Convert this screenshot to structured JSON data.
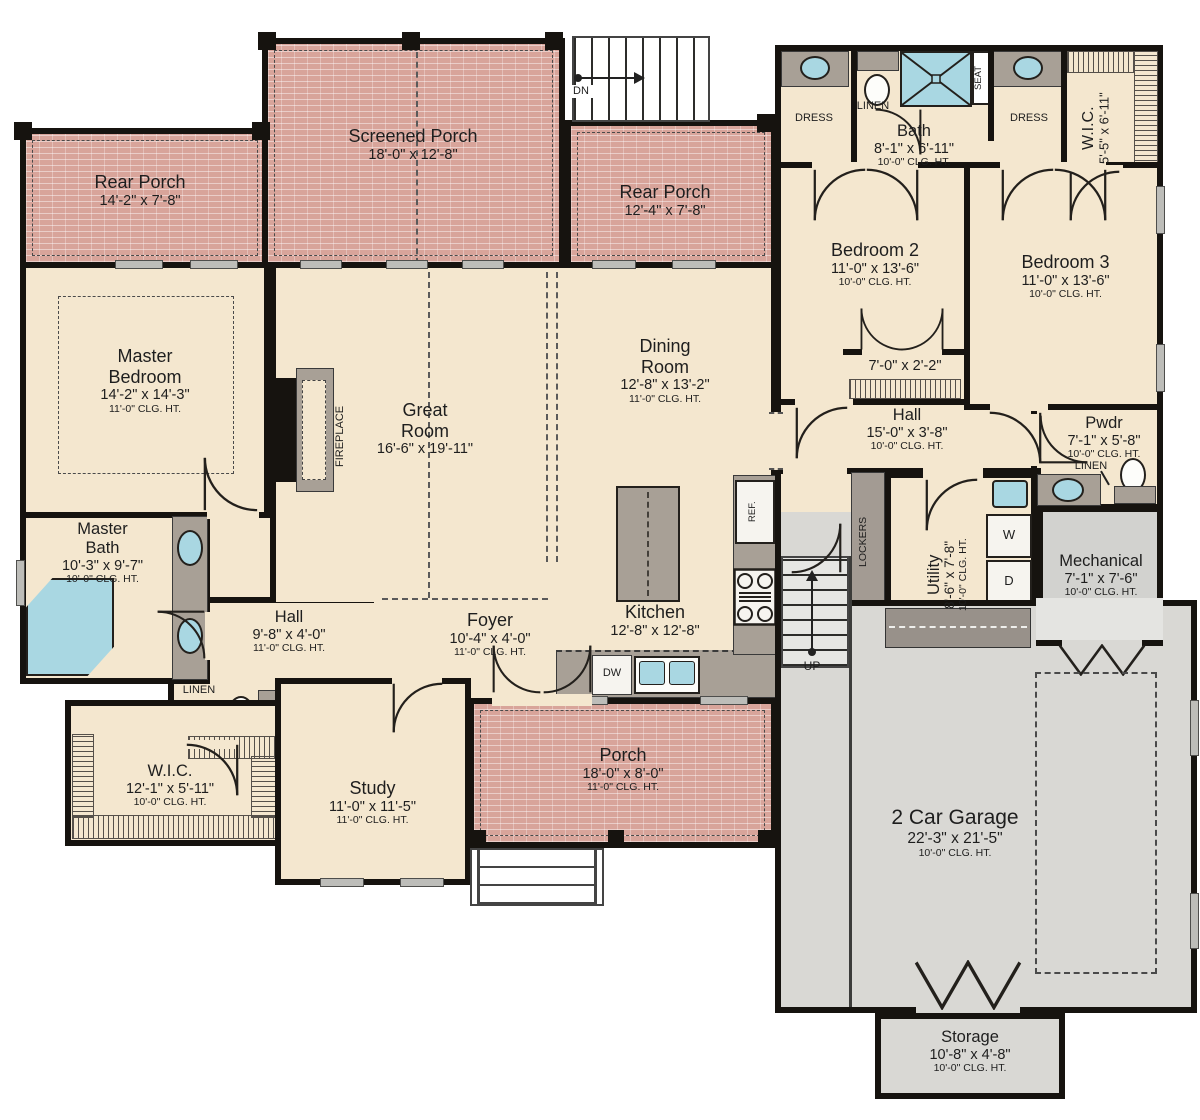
{
  "rooms": {
    "rear_porch_left": {
      "name": "Rear Porch",
      "dims": "14'-2\" x 7'-8\""
    },
    "screened_porch": {
      "name": "Screened Porch",
      "dims": "18'-0\" x 12'-8\""
    },
    "rear_porch_right": {
      "name": "Rear Porch",
      "dims": "12'-4\" x 7'-8\""
    },
    "bath": {
      "name": "Bath",
      "dims": "8'-1\" x 6'-11\"",
      "clg": "10'-0\" CLG. HT."
    },
    "wic_upper": {
      "name": "W.I.C.",
      "dims": "5'-5\" x 6'-11\""
    },
    "bedroom2": {
      "name": "Bedroom 2",
      "dims": "11'-0\" x 13'-6\"",
      "clg": "10'-0\" CLG. HT."
    },
    "bedroom3": {
      "name": "Bedroom 3",
      "dims": "11'-0\" x 13'-6\"",
      "clg": "10'-0\" CLG. HT."
    },
    "closet_between": {
      "dims": "7'-0\" x 2'-2\""
    },
    "hall_bedrooms": {
      "name": "Hall",
      "dims": "15'-0\" x 3'-8\"",
      "clg": "10'-0\" CLG. HT."
    },
    "pwdr": {
      "name": "Pwdr",
      "dims": "7'-1\" x 5'-8\"",
      "clg": "10'-0\" CLG. HT."
    },
    "utility": {
      "name": "Utility",
      "dims": "8'-6\" x 7'-8\"",
      "clg": "10'-0\" CLG. HT."
    },
    "mechanical": {
      "name": "Mechanical",
      "dims": "7'-1\" x 7'-6\"",
      "clg": "10'-0\" CLG. HT."
    },
    "master_bedroom": {
      "name": "Master Bedroom",
      "dims": "14'-2\" x 14'-3\"",
      "clg": "11'-0\" CLG. HT."
    },
    "great_room": {
      "name": "Great Room",
      "dims": "16'-6\" x 19'-11\""
    },
    "dining_room": {
      "name": "Dining Room",
      "dims": "12'-8\" x 13'-2\"",
      "clg": "11'-0\" CLG. HT."
    },
    "kitchen": {
      "name": "Kitchen",
      "dims": "12'-8\" x 12'-8\""
    },
    "master_bath": {
      "name": "Master Bath",
      "dims": "10'-3\" x 9'-7\"",
      "clg": "10'-0\" CLG. HT."
    },
    "hall_master": {
      "name": "Hall",
      "dims": "9'-8\" x 4'-0\"",
      "clg": "11'-0\" CLG. HT."
    },
    "foyer": {
      "name": "Foyer",
      "dims": "10'-4\" x 4'-0\"",
      "clg": "11'-0\" CLG. HT."
    },
    "wic_master": {
      "name": "W.I.C.",
      "dims": "12'-1\" x 5'-11\"",
      "clg": "10'-0\" CLG. HT."
    },
    "study": {
      "name": "Study",
      "dims": "11'-0\" x 11'-5\"",
      "clg": "11'-0\" CLG. HT."
    },
    "front_porch": {
      "name": "Porch",
      "dims": "18'-0\" x 8'-0\"",
      "clg": "11'-0\" CLG. HT."
    },
    "garage": {
      "name": "2 Car Garage",
      "dims": "22'-3\" x 21'-5\"",
      "clg": "10'-0\" CLG. HT."
    },
    "storage": {
      "name": "Storage",
      "dims": "10'-8\" x 4'-8\"",
      "clg": "10'-0\" CLG. HT."
    }
  },
  "fixtures": {
    "stairs_down": "DN",
    "stairs_up": "UP",
    "dress_left": "DRESS",
    "dress_right": "DRESS",
    "linen_bath": "LINEN",
    "linen_pwdr": "LINEN",
    "linen_master": "LINEN",
    "shower_seat": "SEAT",
    "fireplace": "FIREPLACE",
    "lockers": "LOCKERS",
    "refrigerator": "REF.",
    "dishwasher": "DW",
    "washer": "W",
    "dryer": "D"
  },
  "colors": {
    "wall": "#16130f",
    "interior_floor": "#f4e7cf",
    "porch_floor": "#d8a49a",
    "garage_floor": "#d9d8d4",
    "counter": "#a8a096",
    "water_fixture": "#a9d7e2"
  }
}
